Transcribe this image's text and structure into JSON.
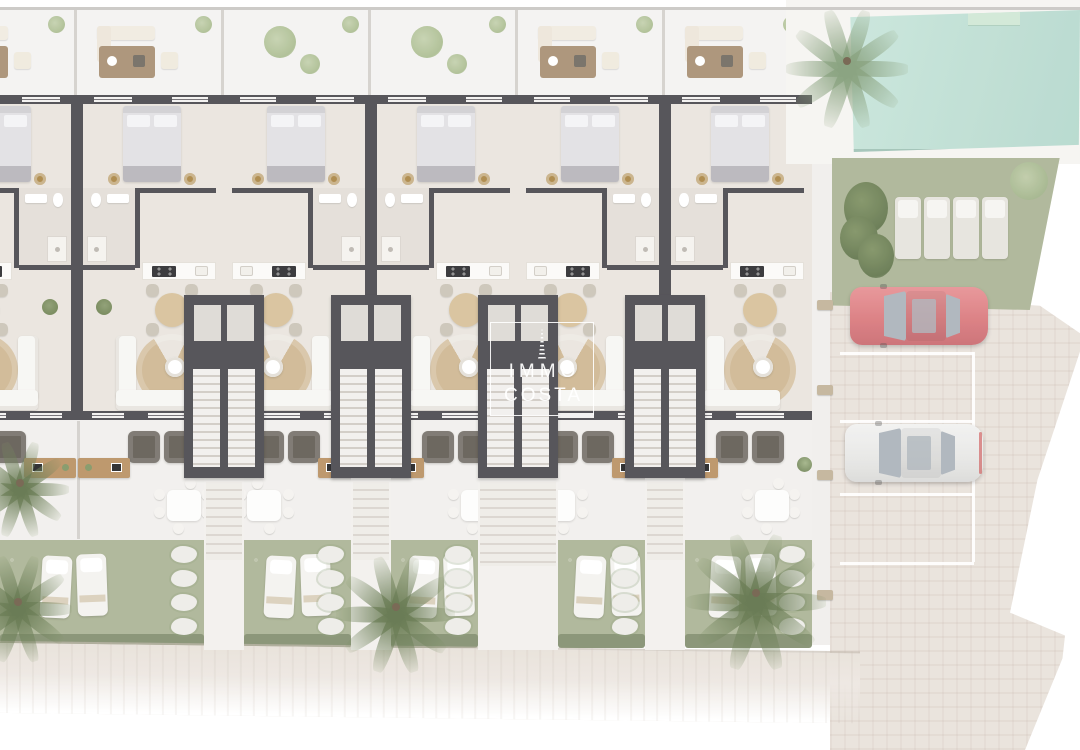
{
  "watermark": {
    "icon": "lighthouse-icon",
    "line1": "IMMO",
    "line2": "COSTA"
  },
  "palette": {
    "wall": "#454349",
    "floorIndoor": "#e9e4dd",
    "floorTerrace": "#f1efec",
    "floorTop": "#f3f2f1",
    "bathFloor": "#e2ddd6",
    "lawn": "#a9b292",
    "lawnDark": "#7f8c6b",
    "pool": "#badcd2",
    "poolSteps": "#cfe7d4",
    "deck": "#f5f4f1",
    "paver": "#e8e1da",
    "topLine": "#c8c6c2",
    "divider": "#d2cfca",
    "glass": "#a9b0b8",
    "rug": "#cdb58f",
    "rugOut": "#a58c6f",
    "wood": "#b78e5e",
    "sofa": "#f7f6f3",
    "chairOut": "#5d574e",
    "chairIn": "#c9c2b5",
    "table": "#d6bf97",
    "bed": "#e0dfe2",
    "bedFoot": "#b5b3b8",
    "pillow": "#f3f3f5",
    "nightstand": "#a8823f",
    "plant": "#6d8150",
    "stone": "#ecebe7",
    "lounger": "#f3f2ef",
    "towel": "#d9cdb8",
    "landing": "#dcd8d3",
    "stripItem": "#c0b096",
    "frond": "#5a6e43",
    "carRed": "#d97579",
    "carWhite": "#ececeb"
  },
  "scene": {
    "modules": {
      "count": 6,
      "width": 147,
      "startX": -70
    },
    "topTerraces": [
      {
        "variant": "sofa"
      },
      {
        "variant": "sofa"
      },
      {
        "variant": "shrubs"
      },
      {
        "variant": "shrubs"
      },
      {
        "variant": "sofa"
      },
      {
        "variant": "sofa"
      }
    ],
    "stairCores": [
      {
        "cx": 224
      },
      {
        "cx": 371
      },
      {
        "cx": 518,
        "wide": true
      },
      {
        "cx": 665
      }
    ],
    "gardens": [
      {
        "x": 0,
        "w": 204
      },
      {
        "x": 244,
        "w": 107
      },
      {
        "x": 391,
        "w": 87
      },
      {
        "x": 558,
        "w": 87
      },
      {
        "x": 685,
        "w": 127
      }
    ],
    "palms": [
      {
        "x": -28,
        "y": 440,
        "s": 95
      },
      {
        "x": -35,
        "y": 555,
        "s": 105
      },
      {
        "x": 338,
        "y": 555,
        "s": 115
      },
      {
        "x": 688,
        "y": 532,
        "s": 135
      },
      {
        "x": 788,
        "y": 8,
        "s": 118,
        "light": true
      }
    ],
    "pool": {
      "x": 848,
      "y": 10,
      "w": 232,
      "h": 142
    },
    "lawn": {
      "padCount": 4,
      "padStartX": 63,
      "padGap": 29,
      "padY": 39
    },
    "parking": {
      "stallLinesY": [
        60,
        128,
        201,
        270
      ],
      "cars": [
        {
          "color": "red",
          "x": 850,
          "y": 287
        },
        {
          "color": "white",
          "x": 845,
          "y": 424
        }
      ]
    },
    "stripItems": [
      {
        "y": 300
      },
      {
        "y": 385
      },
      {
        "y": 470
      },
      {
        "y": 590
      }
    ]
  }
}
